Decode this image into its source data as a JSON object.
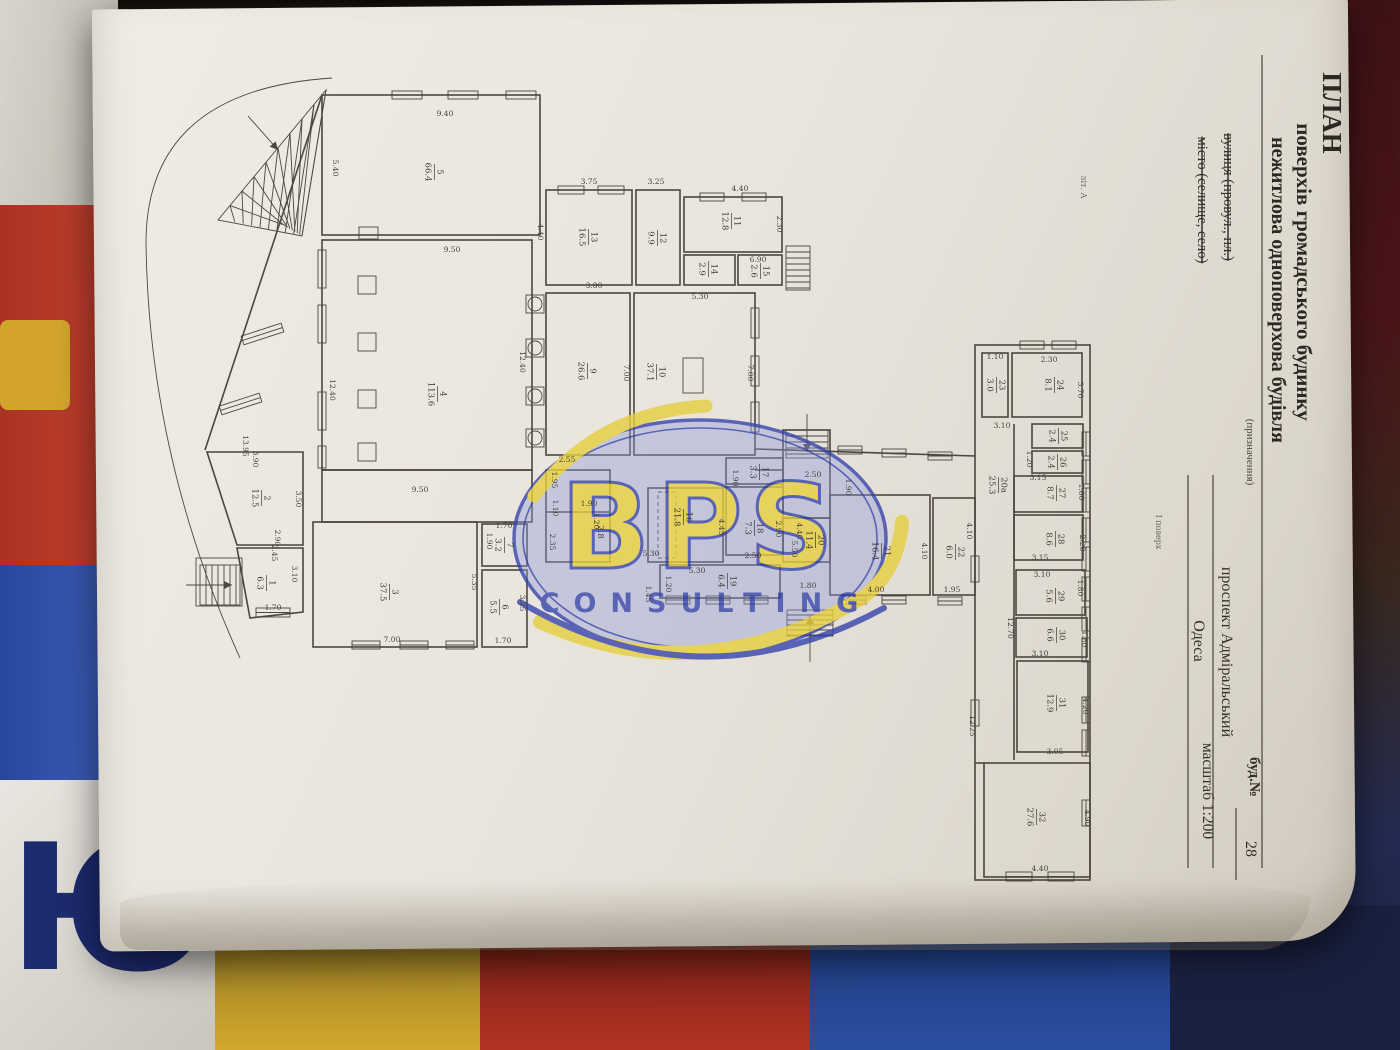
{
  "document": {
    "kind": "photographed floor-plan sheet",
    "floor_note": "І поверх",
    "sheet_mark": "літ. А"
  },
  "title_block": {
    "items": [
      {
        "text": "ПЛАН",
        "x": 1323,
        "y": 113,
        "cls": "t1"
      },
      {
        "text": "поверхів громадського будинку",
        "x": 1297,
        "y": 272,
        "cls": "t2"
      },
      {
        "text": "нежитлова одноповерхова будівля",
        "x": 1272,
        "y": 290,
        "cls": "t3"
      },
      {
        "text": "(призначення)",
        "x": 1247,
        "y": 452,
        "cls": "cap"
      },
      {
        "text": "вулиця (провул., пл.)",
        "x": 1224,
        "y": 197,
        "cls": "lbl",
        "strike": true
      },
      {
        "text": "місто (селище, село)",
        "x": 1198,
        "y": 200,
        "cls": "lbl",
        "strike": true
      },
      {
        "text": "проспект Адміральський",
        "x": 1222,
        "y": 652,
        "cls": "val"
      },
      {
        "text": "Одеса",
        "x": 1194,
        "y": 641,
        "cls": "val"
      },
      {
        "text": "буд.№",
        "x": 1250,
        "y": 777,
        "cls": "lbl2"
      },
      {
        "text": "28",
        "x": 1246,
        "y": 849,
        "cls": "val"
      },
      {
        "text": "масштаб 1:200",
        "x": 1203,
        "y": 791,
        "cls": "val2"
      }
    ]
  },
  "watermark": {
    "brand": "BPS",
    "subtitle": "CONSULTING"
  },
  "background": {
    "letter": "Ю"
  },
  "colors": {
    "paper": "#e9e5dd",
    "ink": "#4b463e",
    "watermark_blue": "#3744ad",
    "watermark_yellow": "#e6cf3f",
    "bg_red": "#b23324",
    "bg_blue": "#2b4fa0",
    "bg_yellow": "#d2a92e",
    "bg_maroon": "#4a1518",
    "bg_navy": "#1a2140"
  },
  "plan": {
    "rooms": [
      {
        "n": "5",
        "a": "66.4",
        "x": 435,
        "y": 172
      },
      {
        "n": "4",
        "a": "113.6",
        "x": 438,
        "y": 394
      },
      {
        "n": "13",
        "a": "16.5",
        "x": 589,
        "y": 237
      },
      {
        "n": "12",
        "a": "9.9",
        "x": 658,
        "y": 238
      },
      {
        "n": "11",
        "a": "12.8",
        "x": 732,
        "y": 221
      },
      {
        "n": "14",
        "a": "2.9",
        "x": 709,
        "y": 269
      },
      {
        "n": "15",
        "a": "2.6",
        "x": 761,
        "y": 271
      },
      {
        "n": "9",
        "a": "26.6",
        "x": 588,
        "y": 371
      },
      {
        "n": "10",
        "a": "37.1",
        "x": 657,
        "y": 372
      },
      {
        "n": "16",
        "a": "21.8",
        "x": 684,
        "y": 517
      },
      {
        "n": "17",
        "a": "3.3",
        "x": 760,
        "y": 472
      },
      {
        "n": "18",
        "a": "7.3",
        "x": 755,
        "y": 528
      },
      {
        "n": "19",
        "a": "6.4",
        "x": 728,
        "y": 581
      },
      {
        "n": "20",
        "a": "11.4",
        "x": 816,
        "y": 540
      },
      {
        "n": "21",
        "a": "16.4",
        "x": 882,
        "y": 551
      },
      {
        "n": "22",
        "a": "6.0",
        "x": 956,
        "y": 552
      },
      {
        "n": "2",
        "a": "12.5",
        "x": 262,
        "y": 498
      },
      {
        "n": "1",
        "a": "6.3",
        "x": 267,
        "y": 583
      },
      {
        "n": "3",
        "a": "37.5",
        "x": 390,
        "y": 592
      },
      {
        "n": "7",
        "a": "3.2",
        "x": 505,
        "y": 545
      },
      {
        "n": "6",
        "a": "5.5",
        "x": 500,
        "y": 607
      },
      {
        "n": "23",
        "a": "3.0",
        "x": 997,
        "y": 385
      },
      {
        "n": "24",
        "a": "8.1",
        "x": 1055,
        "y": 385
      },
      {
        "n": "25",
        "a": "2.4",
        "x": 1059,
        "y": 436
      },
      {
        "n": "26",
        "a": "2.4",
        "x": 1058,
        "y": 462
      },
      {
        "n": "27",
        "a": "8.7",
        "x": 1057,
        "y": 493
      },
      {
        "n": "28",
        "a": "8.6",
        "x": 1056,
        "y": 539
      },
      {
        "n": "29",
        "a": "5.6",
        "x": 1056,
        "y": 596
      },
      {
        "n": "30",
        "a": "6.6",
        "x": 1057,
        "y": 635
      },
      {
        "n": "31",
        "a": "12.9",
        "x": 1057,
        "y": 703
      },
      {
        "n": "32",
        "a": "27.6",
        "x": 1037,
        "y": 817
      },
      {
        "n": "20а",
        "a": "25.3",
        "x": 999,
        "y": 485
      }
    ],
    "area_only": [
      {
        "a": "2.8",
        "x": 598,
        "y": 532
      }
    ],
    "dims": [
      {
        "t": "9.40",
        "x": 445,
        "y": 116,
        "r": 0
      },
      {
        "t": "5.40",
        "x": 333,
        "y": 168,
        "r": 1
      },
      {
        "t": "9.50",
        "x": 452,
        "y": 252,
        "r": 0
      },
      {
        "t": "12.40",
        "x": 330,
        "y": 390,
        "r": 1
      },
      {
        "t": "12.40",
        "x": 520,
        "y": 362,
        "r": 1
      },
      {
        "t": "4.40",
        "x": 538,
        "y": 232,
        "r": 1
      },
      {
        "t": "3.75",
        "x": 589,
        "y": 184,
        "r": 0
      },
      {
        "t": "3.25",
        "x": 656,
        "y": 184,
        "r": 0
      },
      {
        "t": "4.40",
        "x": 740,
        "y": 191,
        "r": 0
      },
      {
        "t": "2.30",
        "x": 777,
        "y": 224,
        "r": 1
      },
      {
        "t": "6.90",
        "x": 758,
        "y": 262,
        "r": 0
      },
      {
        "t": "5.30",
        "x": 700,
        "y": 299,
        "r": 0
      },
      {
        "t": "3.80",
        "x": 594,
        "y": 288,
        "r": 0
      },
      {
        "t": "7.00",
        "x": 624,
        "y": 373,
        "r": 1
      },
      {
        "t": "7.00",
        "x": 748,
        "y": 373,
        "r": 1
      },
      {
        "t": "2.55",
        "x": 567,
        "y": 462,
        "r": 0
      },
      {
        "t": "1.95",
        "x": 552,
        "y": 480,
        "r": 1
      },
      {
        "t": "1.10",
        "x": 553,
        "y": 508,
        "r": 1
      },
      {
        "t": "2.35",
        "x": 550,
        "y": 542,
        "r": 1
      },
      {
        "t": "1.90",
        "x": 589,
        "y": 506,
        "r": 0
      },
      {
        "t": "1.20",
        "x": 594,
        "y": 521,
        "r": 1
      },
      {
        "t": "2.50",
        "x": 813,
        "y": 477,
        "r": 0
      },
      {
        "t": "1.90",
        "x": 733,
        "y": 478,
        "r": 1
      },
      {
        "t": "4.45",
        "x": 719,
        "y": 527,
        "r": 1
      },
      {
        "t": "2.90",
        "x": 776,
        "y": 529,
        "r": 1
      },
      {
        "t": "2.50",
        "x": 753,
        "y": 558,
        "r": 0
      },
      {
        "t": "5.30",
        "x": 651,
        "y": 556,
        "r": 0
      },
      {
        "t": "5.30",
        "x": 697,
        "y": 573,
        "r": 0
      },
      {
        "t": "1.20",
        "x": 666,
        "y": 584,
        "r": 1
      },
      {
        "t": "1.45",
        "x": 646,
        "y": 594,
        "r": 1
      },
      {
        "t": "5.50",
        "x": 792,
        "y": 549,
        "r": 1
      },
      {
        "t": "4.40",
        "x": 797,
        "y": 531,
        "r": 1
      },
      {
        "t": "1.80",
        "x": 808,
        "y": 588,
        "r": 0
      },
      {
        "t": "4.00",
        "x": 876,
        "y": 592,
        "r": 0
      },
      {
        "t": "4.10",
        "x": 922,
        "y": 551,
        "r": 1
      },
      {
        "t": "4.10",
        "x": 967,
        "y": 531,
        "r": 1
      },
      {
        "t": "1.95",
        "x": 952,
        "y": 592,
        "r": 0
      },
      {
        "t": "1.90",
        "x": 846,
        "y": 487,
        "r": 1
      },
      {
        "t": "1.10",
        "x": 995,
        "y": 359,
        "r": 0
      },
      {
        "t": "2.30",
        "x": 1049,
        "y": 362,
        "r": 0
      },
      {
        "t": "3.70",
        "x": 1078,
        "y": 390,
        "r": 1
      },
      {
        "t": "3.10",
        "x": 1002,
        "y": 428,
        "r": 0
      },
      {
        "t": "1.20",
        "x": 1027,
        "y": 459,
        "r": 1
      },
      {
        "t": "3.15",
        "x": 1038,
        "y": 480,
        "r": 0
      },
      {
        "t": "1.80",
        "x": 1079,
        "y": 492,
        "r": 1
      },
      {
        "t": "3.15",
        "x": 1040,
        "y": 560,
        "r": 0
      },
      {
        "t": "2.20",
        "x": 1080,
        "y": 543,
        "r": 1
      },
      {
        "t": "3.10",
        "x": 1042,
        "y": 577,
        "r": 0
      },
      {
        "t": "1.80",
        "x": 1078,
        "y": 588,
        "r": 1
      },
      {
        "t": "3.10",
        "x": 1040,
        "y": 656,
        "r": 0
      },
      {
        "t": "1.80",
        "x": 1082,
        "y": 639,
        "r": 1
      },
      {
        "t": "4.20",
        "x": 1083,
        "y": 706,
        "r": 1
      },
      {
        "t": "3.05",
        "x": 1055,
        "y": 754,
        "r": 0
      },
      {
        "t": "4.40",
        "x": 1040,
        "y": 871,
        "r": 0
      },
      {
        "t": "4.90",
        "x": 1085,
        "y": 818,
        "r": 1
      },
      {
        "t": "12.70",
        "x": 1008,
        "y": 628,
        "r": 1
      },
      {
        "t": "12.25",
        "x": 970,
        "y": 726,
        "r": 1
      },
      {
        "t": "3.50",
        "x": 296,
        "y": 499,
        "r": 1
      },
      {
        "t": "2.90",
        "x": 275,
        "y": 538,
        "r": 1
      },
      {
        "t": "2.45",
        "x": 272,
        "y": 553,
        "r": 1
      },
      {
        "t": "13.95",
        "x": 243,
        "y": 446,
        "r": 1
      },
      {
        "t": "3.90",
        "x": 253,
        "y": 459,
        "r": 1
      },
      {
        "t": "3.10",
        "x": 292,
        "y": 574,
        "r": 1
      },
      {
        "t": "1.70",
        "x": 273,
        "y": 610,
        "r": 0
      },
      {
        "t": "1.70",
        "x": 504,
        "y": 528,
        "r": 0
      },
      {
        "t": "1.90",
        "x": 487,
        "y": 541,
        "r": 1
      },
      {
        "t": "3.25",
        "x": 520,
        "y": 603,
        "r": 1
      },
      {
        "t": "1.70",
        "x": 503,
        "y": 643,
        "r": 0
      },
      {
        "t": "5.35",
        "x": 472,
        "y": 582,
        "r": 1
      },
      {
        "t": "7.00",
        "x": 392,
        "y": 642,
        "r": 0
      },
      {
        "t": "9.50",
        "x": 420,
        "y": 492,
        "r": 0
      }
    ],
    "annotations": [
      {
        "t": "літ. А",
        "x": 1081,
        "y": 187
      },
      {
        "t": "І поверх",
        "x": 1156,
        "y": 532
      }
    ]
  }
}
